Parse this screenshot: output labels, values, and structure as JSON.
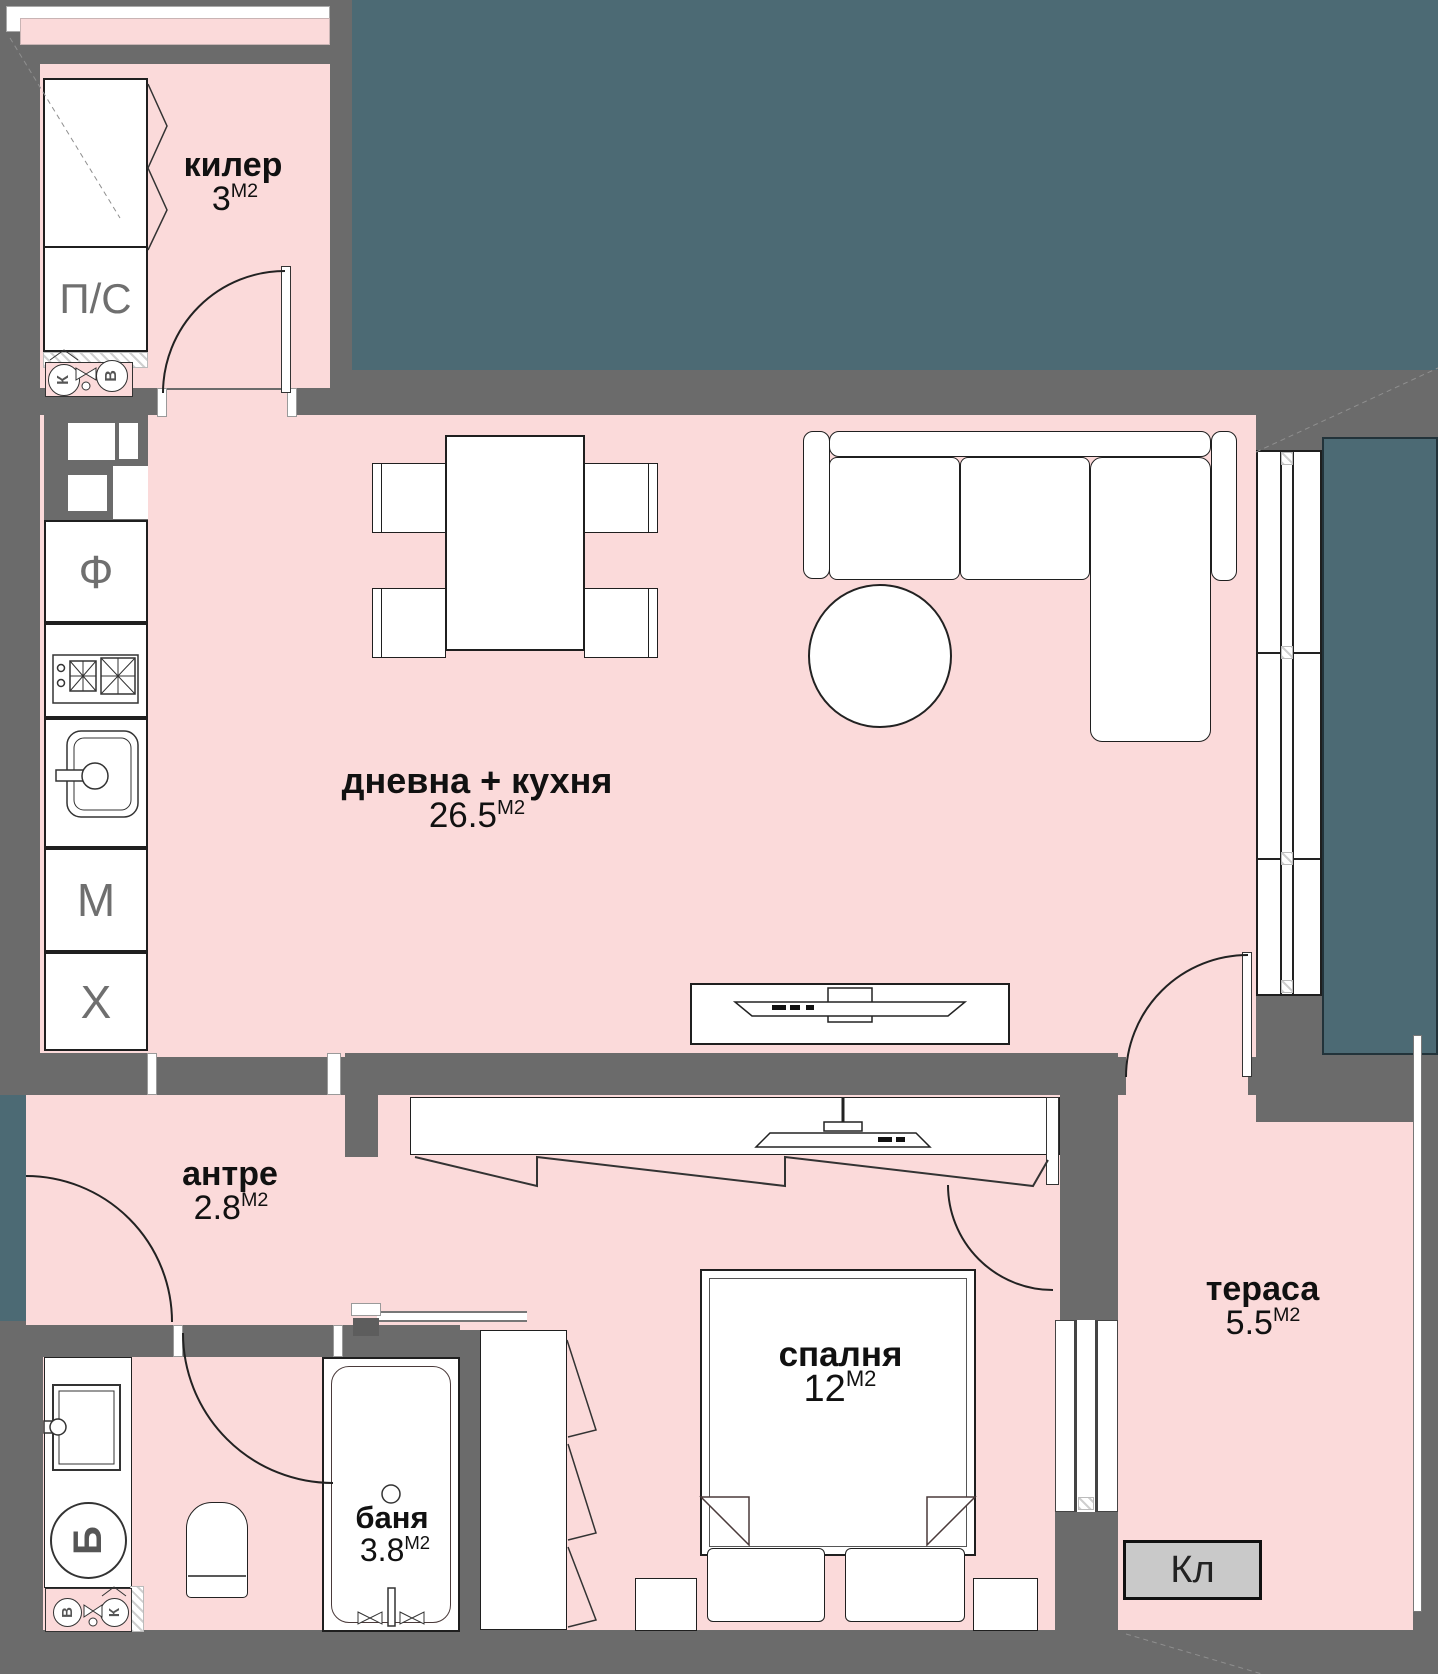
{
  "colors": {
    "wall": "#6b6b6b",
    "room": "#fbdada",
    "outside": "#4c6a74",
    "line": "#1f1f1f",
    "ac": "#c9c9c9",
    "label": "#111111",
    "appliance": "#6f6f6f"
  },
  "rooms": {
    "kiler": {
      "name": "килер",
      "area": "3",
      "unit": "М2"
    },
    "living": {
      "name": "дневна + кухня",
      "area": "26.5",
      "unit": "М2"
    },
    "antre": {
      "name": "антре",
      "area": "2.8",
      "unit": "М2"
    },
    "banya": {
      "name": "баня",
      "area": "3.8",
      "unit": "М2"
    },
    "spalnya": {
      "name": "спалня",
      "area": "12",
      "unit": "М2"
    },
    "terasa": {
      "name": "тераса",
      "area": "5.5",
      "unit": "М2"
    }
  },
  "fixtures": {
    "pantry_unit": "П/С",
    "oven": "Ф",
    "dishwasher": "М",
    "fridge": "Х",
    "boiler": "Б",
    "ac_unit": "Кл",
    "meter_cold": "К",
    "meter_hot": "В"
  }
}
